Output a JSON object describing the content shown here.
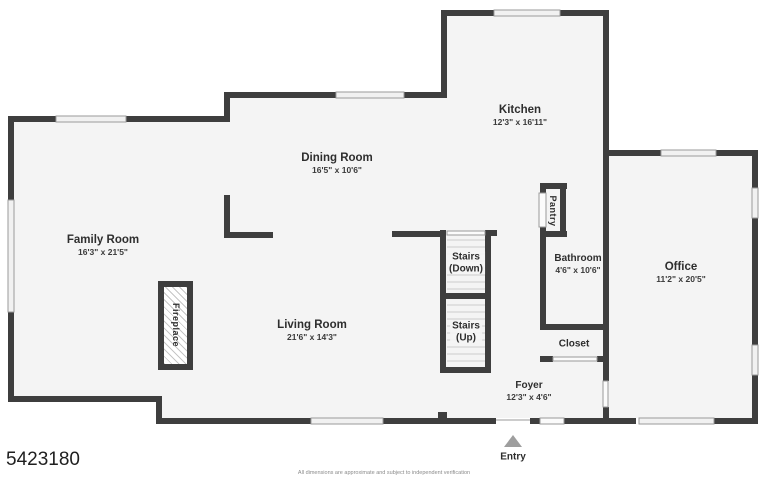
{
  "plan": {
    "listing_id": "5423180",
    "disclaimer": "All dimensions are approximate and subject to independent verification",
    "colors": {
      "wall": "#3e3e3e",
      "floor": "#f4f4f4",
      "window": "#f1f1f1",
      "entry_arrow": "#9e9e9e"
    },
    "rooms": {
      "family": {
        "name": "Family Room",
        "dims": "16'3\" x 21'5\""
      },
      "dining": {
        "name": "Dining Room",
        "dims": "16'5\" x 10'6\""
      },
      "kitchen": {
        "name": "Kitchen",
        "dims": "12'3\" x 16'11\""
      },
      "living": {
        "name": "Living Room",
        "dims": "21'6\" x 14'3\""
      },
      "office": {
        "name": "Office",
        "dims": "11'2\" x 20'5\""
      },
      "bathroom": {
        "name": "Bathroom",
        "dims": "4'6\" x 10'6\""
      },
      "foyer": {
        "name": "Foyer",
        "dims": "12'3\" x 4'6\""
      },
      "closet": {
        "name": "Closet"
      },
      "pantry": {
        "name": "Pantry"
      },
      "fireplace": {
        "name": "Fireplace"
      },
      "stairs_down": {
        "name": "Stairs",
        "sub": "(Down)"
      },
      "stairs_up": {
        "name": "Stairs",
        "sub": "(Up)"
      },
      "entry": {
        "name": "Entry"
      }
    }
  }
}
